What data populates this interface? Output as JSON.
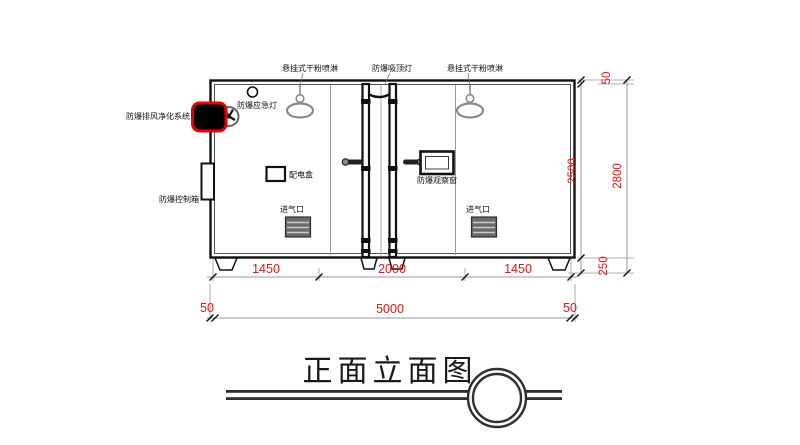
{
  "drawing_title": "正面立面图",
  "labels": {
    "sprinkler_left": "悬挂式干粉喷淋",
    "ceiling_lamp": "防爆吸顶灯",
    "sprinkler_right": "悬挂式干粉喷淋",
    "emergency_lamp": "防爆应急灯",
    "purifier_unit": "防爆排风净化系统",
    "control_cabinet": "防爆控制箱",
    "power_box": "配电盒",
    "observation_window": "防爆观察窗",
    "air_inlet_left": "进气口",
    "air_inlet_right": "进气口"
  },
  "dimensions": {
    "bottom_segments": [
      "1450",
      "2000",
      "1450"
    ],
    "bottom_left_offset": "50",
    "bottom_total": "5000",
    "bottom_right_offset": "50",
    "right_top_offset": "50",
    "right_inner_height": "2500",
    "right_total_height": "2800",
    "right_base_height": "250"
  },
  "colors": {
    "dimension_text": "#ee1111",
    "alarm_unit_outline": "#e80000",
    "line": "#1a1a1a",
    "gray_symbol": "#8a8a8a"
  }
}
